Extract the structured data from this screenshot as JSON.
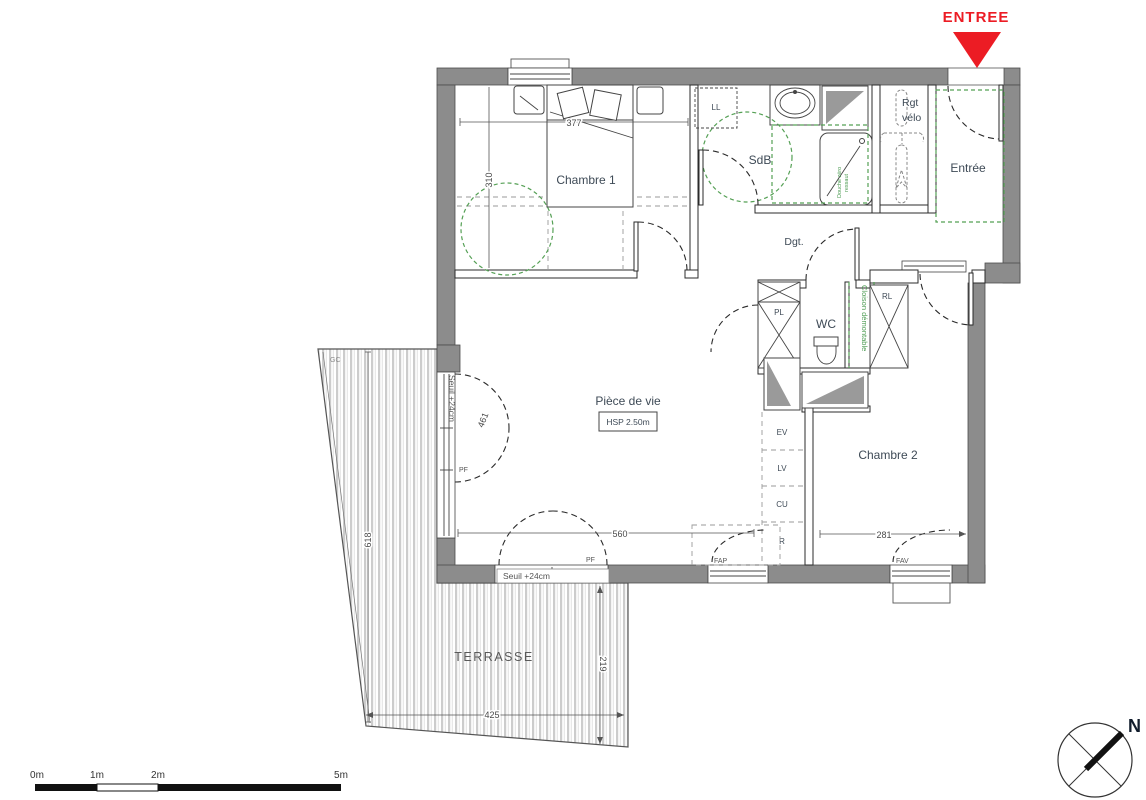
{
  "entry_marker": {
    "label": "ENTREE"
  },
  "rooms": {
    "chambre1": "Chambre 1",
    "sdb": "SdB",
    "rgt_velo_line1": "Rgt",
    "rgt_velo_line2": "vélo",
    "entree": "Entrée",
    "dgt": "Dgt.",
    "wc": "WC",
    "piece_de_vie": "Pièce de vie",
    "hsp": "HSP 2.50m",
    "chambre2": "Chambre 2",
    "terrasse": "TERRASSE"
  },
  "fixtures": {
    "ll": "LL",
    "pl": "PL",
    "rl": "RL",
    "ev": "EV",
    "lv": "LV",
    "cu": "CU",
    "r": "R"
  },
  "annotations": {
    "cloison_demontable": "Cloison démontable",
    "douche_line1": "Douche zéro",
    "douche_line2": "ressaut",
    "seuil_left": "Seuil +24cm",
    "seuil_bottom": "Seuil +24cm",
    "gc": "GC"
  },
  "window_tags": {
    "pf_left": "PF",
    "pf_bottom": "PF",
    "fap": "FAP",
    "fav": "FAV"
  },
  "dimensions": {
    "chambre1_width": "377",
    "chambre1_depth": "310",
    "left_bay": "461",
    "living_width": "560",
    "chambre2_width": "281",
    "terrace_length": "618",
    "terrace_width": "425",
    "terrace_depth": "219"
  },
  "scale_bar": {
    "m0": "0m",
    "m1": "1m",
    "m2": "2m",
    "m5": "5m"
  },
  "compass": {
    "north": "N"
  },
  "colors": {
    "wall": "#8c8c8c",
    "accent_red": "#ec1c24",
    "accessibility_green": "#55a055",
    "label": "#3e4a56"
  }
}
